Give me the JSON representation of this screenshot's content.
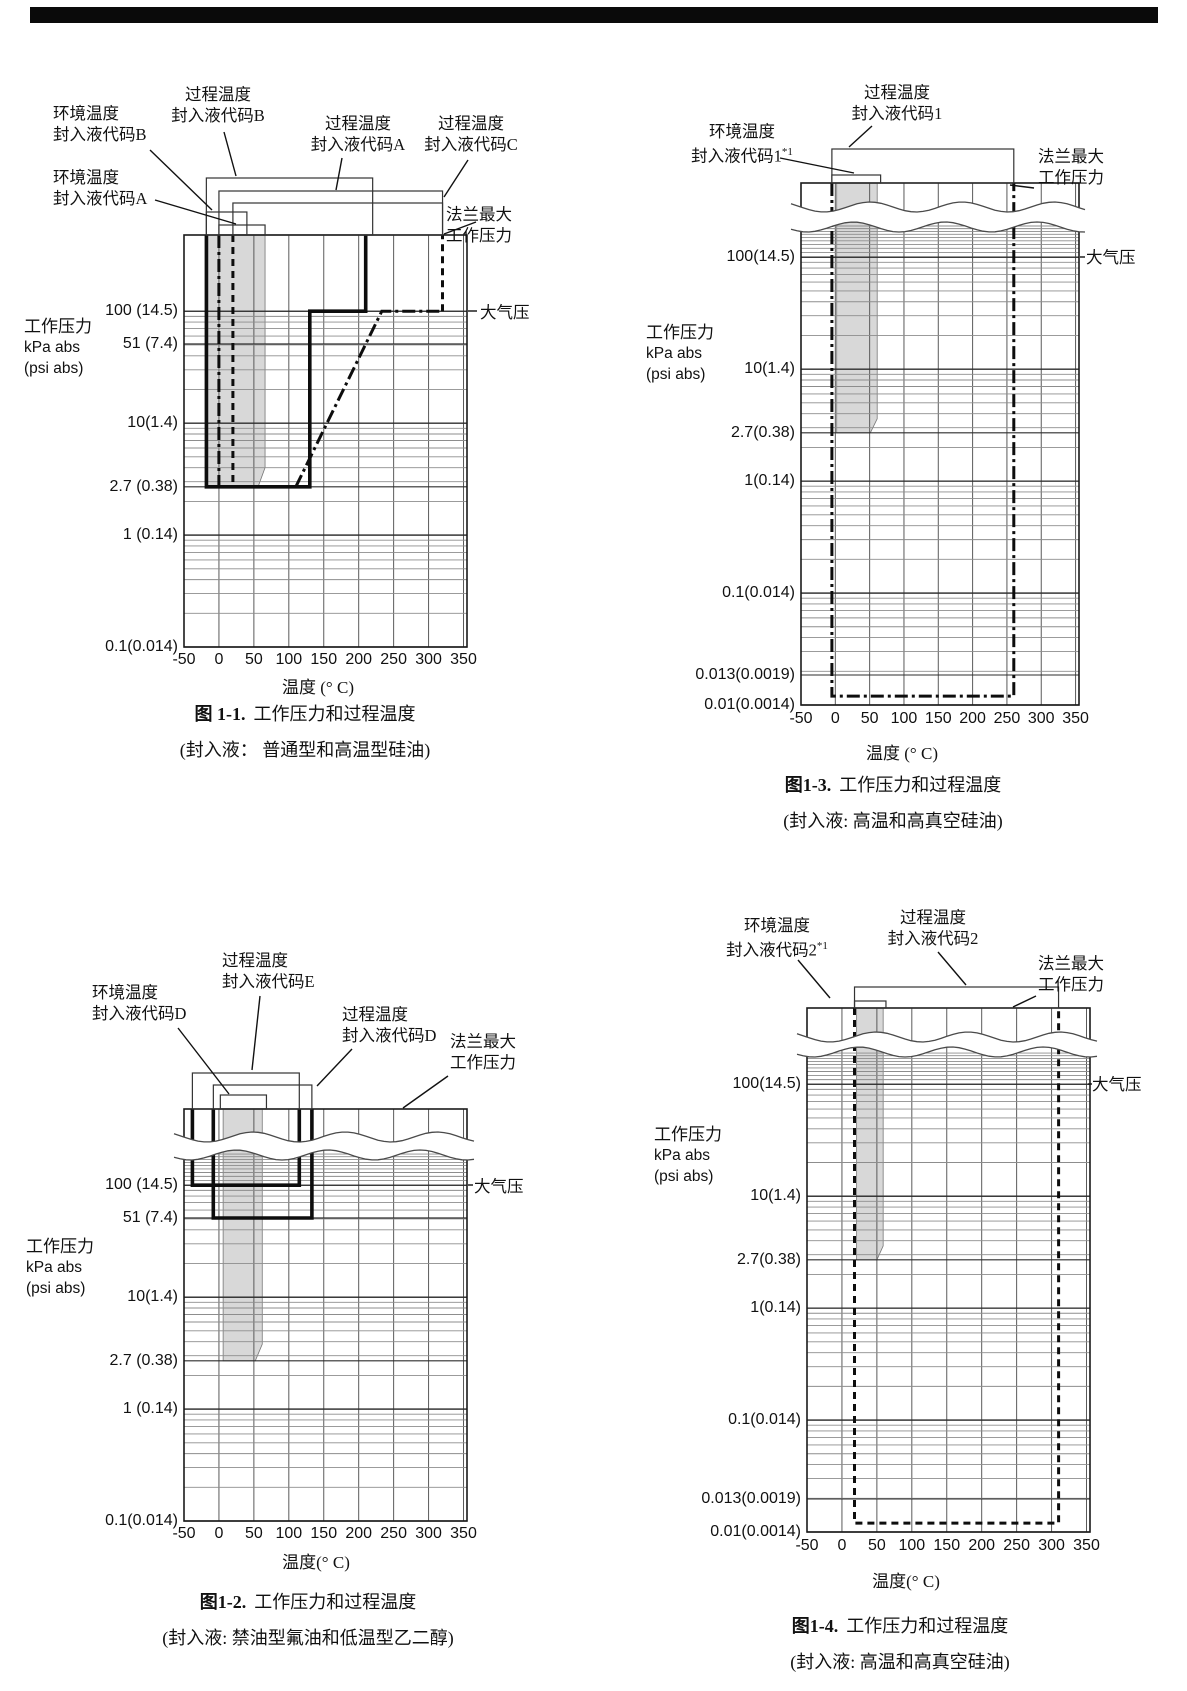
{
  "page": {
    "width": 1187,
    "height": 1691,
    "top_bar": {
      "x": 30,
      "y": 7,
      "w": 1128,
      "h": 16,
      "color": "#0a0a0a"
    },
    "ink_color": "#111111",
    "gray_band_color": "#d8d8d8"
  },
  "chart_data": [
    {
      "type": "line",
      "name": "fig-1-1",
      "caption_fig": "图 1-1.",
      "caption_title": "工作压力和过程温度",
      "caption_sub": "(封入液： 普通型和高温型硅油)",
      "caption_cx": 305,
      "caption_y": 703,
      "caption_sub_y": 739,
      "xlabel": "温度 (° C)",
      "xlabel_cx": 318,
      "xlabel_y": 673,
      "unit_lines": [
        "工作压力",
        "kPa abs",
        "(psi abs)"
      ],
      "unit_x": 24,
      "unit_y": 316,
      "plot": {
        "l": 184,
        "t": 235,
        "r": 467,
        "b": 647
      },
      "x_axis": {
        "min": -50,
        "max": 350,
        "step": 50,
        "edge": 355,
        "tick_y": 650
      },
      "y_axis": {
        "p_bottom": 0.1,
        "p_top": 480,
        "grid_top": 100,
        "tick_right": 178,
        "ticks": [
          {
            "v": 100,
            "label": "100 (14.5)"
          },
          {
            "v": 51,
            "label": "51 (7.4)"
          },
          {
            "v": 10,
            "label": "10(1.4)"
          },
          {
            "v": 2.7,
            "label": "2.7 (0.38)"
          },
          {
            "v": 1,
            "label": "1 (0.14)"
          },
          {
            "v": 0.1,
            "label": "0.1(0.014)"
          }
        ]
      },
      "wavy": null,
      "gray_band": {
        "x1": -16,
        "x2": 66,
        "p_bot": 2.7,
        "taper_x": 56,
        "taper_p": 4.0
      },
      "rects_above": [
        {
          "name": "process-temp-code-B",
          "x1": -18,
          "x2": 220,
          "top": 178
        },
        {
          "name": "process-temp-code-A",
          "x1": 0,
          "x2": 320,
          "top": 191
        },
        {
          "name": "process-temp-code-C",
          "x1": 20,
          "x2": 320,
          "top": 203
        },
        {
          "name": "ambient-temp-code-B",
          "x1": -18,
          "x2": 40,
          "top": 212
        },
        {
          "name": "ambient-temp-code-A",
          "x1": 0,
          "x2": 66,
          "top": 225
        }
      ],
      "series": [
        {
          "name": "code-B-boundary",
          "style": "thick",
          "points": [
            [
              -18,
              "T"
            ],
            [
              -18,
              2.7
            ],
            [
              130,
              2.7
            ],
            [
              130,
              100
            ],
            [
              210,
              100
            ],
            [
              210,
              "T"
            ]
          ]
        },
        {
          "name": "ambient-lower-dashdot",
          "style": "dashdot",
          "points": [
            [
              0,
              "T"
            ],
            [
              0,
              2.7
            ]
          ]
        },
        {
          "name": "ambient-upper-dashed",
          "style": "dashed",
          "points": [
            [
              20,
              "T"
            ],
            [
              20,
              2.7
            ]
          ]
        },
        {
          "name": "code-C-lower-boundary",
          "style": "dashdot",
          "points": [
            [
              110,
              2.7
            ],
            [
              233,
              100
            ],
            [
              320,
              100
            ]
          ]
        },
        {
          "name": "code-C-upper-boundary",
          "style": "dashed",
          "points": [
            [
              320,
              100
            ],
            [
              320,
              "T"
            ]
          ]
        }
      ],
      "callouts": [
        {
          "lines": [
            "过程温度",
            "封入液代码B"
          ],
          "x": 157,
          "y": 84,
          "w": 122,
          "align": "center",
          "conn": [
            [
              224,
              132
            ],
            [
              236,
              176
            ]
          ]
        },
        {
          "lines": [
            "环境温度",
            "封入液代码B"
          ],
          "x": 53,
          "y": 103,
          "w": 112,
          "align": "left",
          "conn": [
            [
              150,
              150
            ],
            [
              212,
              210
            ]
          ]
        },
        {
          "lines": [
            "环境温度",
            "封入液代码A"
          ],
          "x": 53,
          "y": 167,
          "w": 112,
          "align": "left",
          "conn": [
            [
              155,
              200
            ],
            [
              236,
              224
            ]
          ]
        },
        {
          "lines": [
            "过程温度",
            "封入液代码A"
          ],
          "x": 302,
          "y": 113,
          "w": 112,
          "align": "center",
          "conn": [
            [
              342,
              158
            ],
            [
              336,
              190
            ]
          ]
        },
        {
          "lines": [
            "过程温度",
            "封入液代码C"
          ],
          "x": 415,
          "y": 113,
          "w": 112,
          "align": "center",
          "conn": [
            [
              468,
              160
            ],
            [
              444,
              197
            ]
          ]
        },
        {
          "lines": [
            "法兰最大",
            "工作压力"
          ],
          "x": 446,
          "y": 204,
          "w": 90,
          "align": "left",
          "conn": [
            [
              476,
              222
            ],
            [
              444,
              234
            ]
          ]
        },
        {
          "lines": [
            "大气压"
          ],
          "x": 480,
          "y": 302,
          "w": 70,
          "align": "left",
          "conn": [
            [
              468,
              311
            ],
            [
              477,
              311
            ]
          ]
        }
      ]
    },
    {
      "type": "line",
      "name": "fig-1-3",
      "caption_fig": "图1-3.",
      "caption_title": "工作压力和过程温度",
      "caption_sub": "(封入液: 高温和高真空硅油)",
      "caption_cx": 893,
      "caption_y": 774,
      "caption_sub_y": 810,
      "xlabel": "温度 (° C)",
      "xlabel_cx": 902,
      "xlabel_y": 739,
      "unit_lines": [
        "工作压力",
        "kPa abs",
        "(psi abs)"
      ],
      "unit_x": 646,
      "unit_y": 322,
      "plot": {
        "l": 801,
        "t": 183,
        "r": 1079,
        "b": 705
      },
      "x_axis": {
        "min": -50,
        "max": 350,
        "step": 50,
        "edge": 355,
        "tick_y": 709
      },
      "y_axis": {
        "p_bottom": 0.01,
        "p_top": 460,
        "grid_top": 200,
        "tick_right": 795,
        "ticks": [
          {
            "v": 100,
            "label": "100(14.5)"
          },
          {
            "v": 10,
            "label": "10(1.4)"
          },
          {
            "v": 2.7,
            "label": "2.7(0.38)"
          },
          {
            "v": 1,
            "label": "1(0.14)"
          },
          {
            "v": 0.1,
            "label": "0.1(0.014)"
          },
          {
            "v": 0.013,
            "label": "0.013(0.0019)",
            "py": 675
          },
          {
            "v": 0.01,
            "label": "0.01(0.0014)"
          }
        ]
      },
      "wavy": {
        "t_off": 24,
        "b_off": 44
      },
      "gray_band": {
        "x1": 2,
        "x2": 61,
        "p_bot": 2.7,
        "taper_x": 51,
        "taper_p": 3.6
      },
      "rects_above": [
        {
          "name": "process-temp-code-1",
          "x1": -5,
          "x2": 260,
          "top": 149
        },
        {
          "name": "ambient-temp-code-1",
          "x1": -5,
          "x2": 66,
          "top": 175
        }
      ],
      "series": [
        {
          "name": "code-1-boundary",
          "style": "dashdot",
          "points": [
            [
              -5,
              "T"
            ],
            [
              -5,
              0.012
            ],
            [
              260,
              0.012
            ],
            [
              260,
              "T"
            ]
          ]
        }
      ],
      "callouts": [
        {
          "lines": [
            "过程温度",
            "封入液代码1"
          ],
          "x": 835,
          "y": 82,
          "w": 124,
          "align": "center",
          "conn": [
            [
              872,
              126
            ],
            [
              849,
              147
            ]
          ]
        },
        {
          "lines": [
            "环境温度",
            "封入液代码1*1"
          ],
          "x": 682,
          "y": 121,
          "w": 120,
          "align": "center",
          "conn": [
            [
              780,
              158
            ],
            [
              854,
              173
            ]
          ]
        },
        {
          "lines": [
            "法兰最大",
            "工作压力"
          ],
          "x": 1038,
          "y": 146,
          "w": 90,
          "align": "left",
          "conn": [
            [
              1034,
              188
            ],
            [
              1010,
              185
            ]
          ]
        },
        {
          "lines": [
            "大气压"
          ],
          "x": 1086,
          "y": 247,
          "w": 70,
          "align": "left",
          "conn": [
            [
              1080,
              257
            ],
            [
              1085,
              257
            ]
          ]
        }
      ]
    },
    {
      "type": "line",
      "name": "fig-1-2",
      "caption_fig": "图1-2.",
      "caption_title": "工作压力和过程温度",
      "caption_sub": "(封入液: 禁油型氟油和低温型乙二醇)",
      "caption_cx": 308,
      "caption_y": 1591,
      "caption_sub_y": 1627,
      "xlabel": "温度(° C)",
      "xlabel_cx": 316,
      "xlabel_y": 1548,
      "unit_lines": [
        "工作压力",
        "kPa abs",
        "(psi abs)"
      ],
      "unit_x": 26,
      "unit_y": 1236,
      "plot": {
        "l": 184,
        "t": 1109,
        "r": 467,
        "b": 1521
      },
      "x_axis": {
        "min": -50,
        "max": 350,
        "step": 50,
        "edge": 355,
        "tick_y": 1524
      },
      "y_axis": {
        "p_bottom": 0.1,
        "p_top": 480,
        "grid_top": 200,
        "tick_right": 178,
        "ticks": [
          {
            "v": 100,
            "label": "100 (14.5)"
          },
          {
            "v": 51,
            "label": "51 (7.4)"
          },
          {
            "v": 10,
            "label": "10(1.4)"
          },
          {
            "v": 2.7,
            "label": "2.7 (0.38)"
          },
          {
            "v": 1,
            "label": "1 (0.14)"
          },
          {
            "v": 0.1,
            "label": "0.1(0.014)"
          }
        ]
      },
      "wavy": {
        "t_off": 28,
        "b_off": 46
      },
      "gray_band": {
        "x1": 6,
        "x2": 62,
        "p_bot": 2.7,
        "taper_x": 52,
        "taper_p": 3.8
      },
      "rects_above": [
        {
          "name": "process-temp-code-E",
          "x1": -38,
          "x2": 115,
          "top": 1073
        },
        {
          "name": "process-temp-code-D",
          "x1": -8,
          "x2": 133,
          "top": 1085
        },
        {
          "name": "ambient-temp-code-D",
          "x1": 2,
          "x2": 68,
          "top": 1095
        }
      ],
      "series": [
        {
          "name": "code-E-boundary",
          "style": "thick",
          "points": [
            [
              -38,
              "T"
            ],
            [
              -38,
              100
            ],
            [
              115,
              100
            ],
            [
              115,
              "T"
            ]
          ]
        },
        {
          "name": "code-D-boundary",
          "style": "thick",
          "points": [
            [
              -8,
              "T"
            ],
            [
              -8,
              51
            ],
            [
              133,
              51
            ],
            [
              133,
              "T"
            ]
          ]
        }
      ],
      "callouts": [
        {
          "lines": [
            "环境温度",
            "封入液代码D"
          ],
          "x": 92,
          "y": 982,
          "w": 115,
          "align": "left",
          "conn": [
            [
              178,
              1028
            ],
            [
              229,
              1094
            ]
          ]
        },
        {
          "lines": [
            "过程温度",
            "封入液代码E"
          ],
          "x": 222,
          "y": 950,
          "w": 115,
          "align": "left",
          "conn": [
            [
              260,
              996
            ],
            [
              252,
              1070
            ]
          ]
        },
        {
          "lines": [
            "过程温度",
            "封入液代码D"
          ],
          "x": 342,
          "y": 1004,
          "w": 115,
          "align": "left",
          "conn": [
            [
              352,
              1049
            ],
            [
              317,
              1086
            ]
          ]
        },
        {
          "lines": [
            "法兰最大",
            "工作压力"
          ],
          "x": 450,
          "y": 1031,
          "w": 90,
          "align": "left",
          "conn": [
            [
              448,
              1076
            ],
            [
              403,
              1108
            ]
          ]
        },
        {
          "lines": [
            "大气压"
          ],
          "x": 474,
          "y": 1176,
          "w": 70,
          "align": "left",
          "conn": [
            [
              468,
              1185
            ],
            [
              473,
              1185
            ]
          ]
        }
      ]
    },
    {
      "type": "line",
      "name": "fig-1-4",
      "caption_fig": "图1-4.",
      "caption_title": "工作压力和过程温度",
      "caption_sub": "(封入液: 高温和高真空硅油)",
      "caption_cx": 900,
      "caption_y": 1615,
      "caption_sub_y": 1651,
      "xlabel": "温度(° C)",
      "xlabel_cx": 906,
      "xlabel_y": 1567,
      "unit_lines": [
        "工作压力",
        "kPa abs",
        "(psi abs)"
      ],
      "unit_x": 654,
      "unit_y": 1124,
      "plot": {
        "l": 807,
        "t": 1008,
        "r": 1090,
        "b": 1532
      },
      "x_axis": {
        "min": -50,
        "max": 350,
        "step": 50,
        "edge": 355,
        "tick_y": 1536
      },
      "y_axis": {
        "p_bottom": 0.01,
        "p_top": 480,
        "grid_top": 200,
        "tick_right": 801,
        "ticks": [
          {
            "v": 100,
            "label": "100(14.5)"
          },
          {
            "v": 10,
            "label": "10(1.4)"
          },
          {
            "v": 2.7,
            "label": "2.7(0.38)"
          },
          {
            "v": 1,
            "label": "1(0.14)"
          },
          {
            "v": 0.1,
            "label": "0.1(0.014)"
          },
          {
            "v": 0.013,
            "label": "0.013(0.0019)",
            "py": 1499
          },
          {
            "v": 0.01,
            "label": "0.01(0.0014)"
          }
        ]
      },
      "wavy": {
        "t_off": 29,
        "b_off": 44
      },
      "gray_band": {
        "x1": 21,
        "x2": 59,
        "p_bot": 2.7,
        "taper_x": 50,
        "taper_p": 3.6
      },
      "rects_above": [
        {
          "name": "process-temp-code-2",
          "x1": 18,
          "x2": 310,
          "top": 987
        },
        {
          "name": "ambient-temp-code-2",
          "x1": 18,
          "x2": 63,
          "top": 1001
        }
      ],
      "series": [
        {
          "name": "code-2-boundary",
          "style": "dashed",
          "points": [
            [
              18,
              "T"
            ],
            [
              18,
              0.012
            ],
            [
              310,
              0.012
            ],
            [
              310,
              "T"
            ]
          ]
        }
      ],
      "callouts": [
        {
          "lines": [
            "环境温度",
            "封入液代码2*1"
          ],
          "x": 716,
          "y": 915,
          "w": 122,
          "align": "center",
          "conn": [
            [
              798,
              960
            ],
            [
              830,
              998
            ]
          ]
        },
        {
          "lines": [
            "过程温度",
            "封入液代码2"
          ],
          "x": 872,
          "y": 907,
          "w": 122,
          "align": "center",
          "conn": [
            [
              938,
              952
            ],
            [
              966,
              985
            ]
          ]
        },
        {
          "lines": [
            "法兰最大",
            "工作压力"
          ],
          "x": 1038,
          "y": 953,
          "w": 90,
          "align": "left",
          "conn": [
            [
              1036,
              996
            ],
            [
              1013,
              1007
            ]
          ]
        },
        {
          "lines": [
            "大气压"
          ],
          "x": 1092,
          "y": 1074,
          "w": 70,
          "align": "left",
          "conn": [
            [
              1088,
              1084
            ],
            [
              1092,
              1084
            ]
          ]
        }
      ]
    }
  ]
}
